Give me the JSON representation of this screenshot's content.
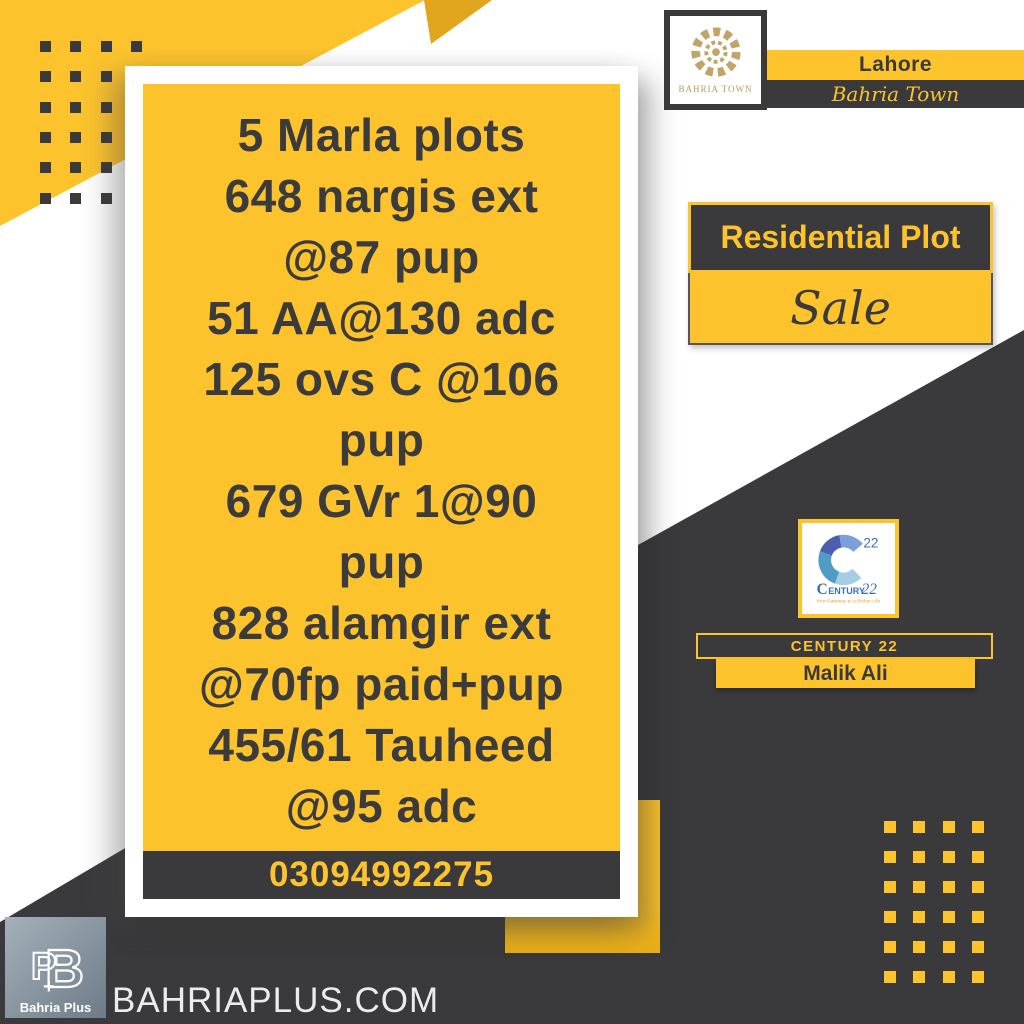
{
  "poster": {
    "card": {
      "lines": [
        "5 Marla plots",
        "648 nargis ext",
        "@87 pup",
        "51 AA@130 adc",
        "125 ovs C @106",
        "pup",
        "679 GVr 1@90",
        "pup",
        "828 alamgir ext",
        "@70fp paid+pup",
        "455/61 Tauheed",
        "@95 adc"
      ],
      "phone": "03094992275"
    },
    "bahria_town": {
      "logo_caption": "BAHRIA TOWN",
      "city": "Lahore",
      "brand_script": "Bahria Town"
    },
    "listing": {
      "category": "Residential Plot",
      "status": "Sale"
    },
    "agency": {
      "logo_number": "22",
      "logo_word_c": "C",
      "logo_word_rest": "ENTURY",
      "logo_word_22": "22",
      "logo_tagline": "Your Gateway to a Richer Life",
      "company_bar": "CENTURY 22",
      "agent_name": "Malik Ali"
    },
    "footer": {
      "logo_caption": "Bahria Plus",
      "website": "BAHRIAPLUS.COM"
    },
    "colors": {
      "yellow": "#fcc32d",
      "dark": "#3a3a3c",
      "gold": "#b89a5e",
      "century_blue": "#3b6fb5",
      "tagline_orange": "#f09e2e"
    }
  }
}
